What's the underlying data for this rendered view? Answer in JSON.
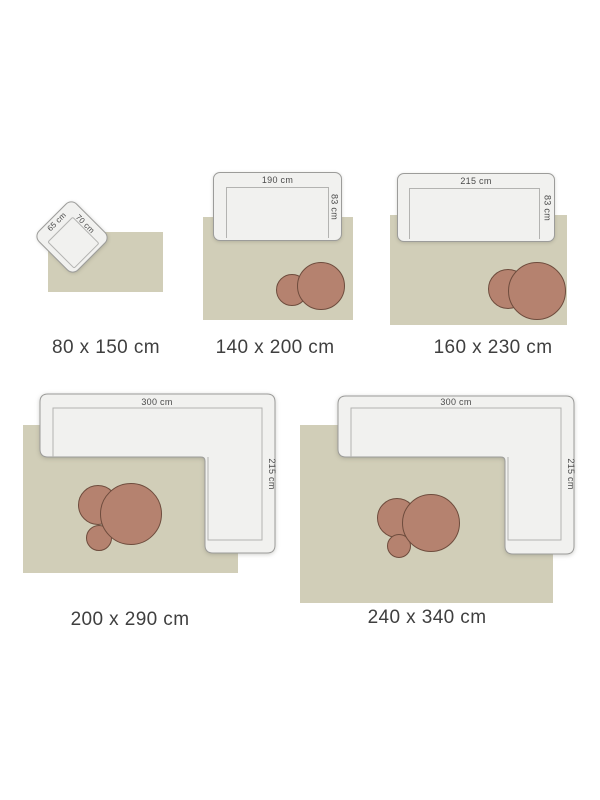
{
  "colors": {
    "page_bg": "#ffffff",
    "rug_fill": "#d1ceb8",
    "sofa_fill": "#f1f1ef",
    "sofa_border": "#9c9c9a",
    "seat_line": "#b3b3b1",
    "pouf_fill": "#b5826f",
    "pouf_border": "#6e4c3d",
    "caption_text": "#3f3f3f",
    "dim_text": "#4a4a4a"
  },
  "diagrams": [
    {
      "caption": "80 x 150 cm",
      "furniture": {
        "type": "armchair",
        "width_label": "65 cm",
        "depth_label": "70 cm"
      }
    },
    {
      "caption": "140 x 200 cm",
      "furniture": {
        "type": "sofa",
        "width_label": "190 cm",
        "depth_label": "83 cm"
      }
    },
    {
      "caption": "160 x 230 cm",
      "furniture": {
        "type": "sofa",
        "width_label": "215 cm",
        "depth_label": "83 cm"
      }
    },
    {
      "caption": "200 x 290 cm",
      "furniture": {
        "type": "corner-sofa",
        "width_label": "300 cm",
        "depth_label": "215 cm"
      }
    },
    {
      "caption": "240 x 340 cm",
      "furniture": {
        "type": "corner-sofa",
        "width_label": "300 cm",
        "depth_label": "215 cm"
      }
    }
  ]
}
